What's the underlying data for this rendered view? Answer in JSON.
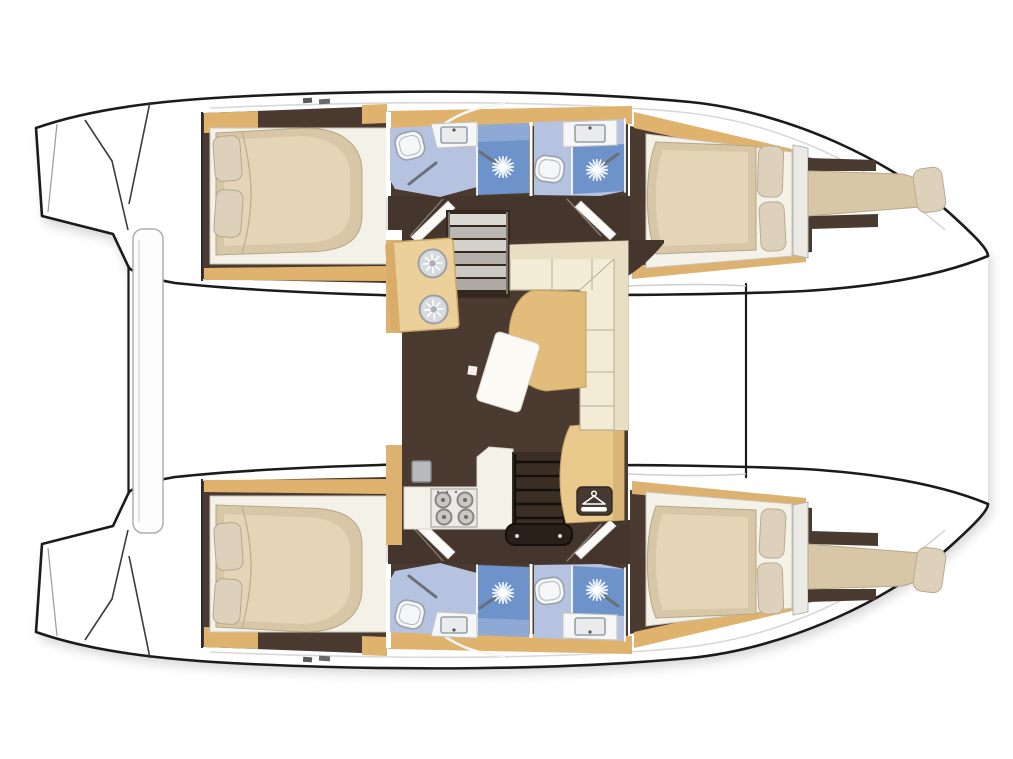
{
  "meta": {
    "type": "boat-floor-plan",
    "subject": "catamaran sailing yacht accommodation layout, top-down view",
    "orientation": "bow-right, sterns-left",
    "layout_name": "4-cabin / 4-bathroom catamaran with central saloon"
  },
  "palette": {
    "outline": "#1b1b1b",
    "shadow": "#c4c4c4",
    "deck": "#ffffff",
    "floor": "#4a3a30",
    "corridor": "#45362d",
    "wood": "#dfb26e",
    "cabinet": "#ecd09a",
    "wardrobe": "#e9c98c",
    "dark_wood": "#3a2e25",
    "settee": "#f2ebd6",
    "settee_back": "#e8dec4",
    "table": "#e2bc7a",
    "mattress": "#d8c7a7",
    "mattress_hi": "#e5d7b8",
    "bed_base": "#f4f1e9",
    "pillow": "#ddd1bb",
    "bath_floor": "#b5c3e0",
    "shower": "#6e93cb",
    "fixture_white": "#f4f6f8",
    "steel": "#b7babd",
    "icon_bg": "#463931"
  },
  "rooms": {
    "port_hull": [
      "aft double cabin",
      "aft bathroom (toilet, sink, shower)",
      "forward bathroom (toilet, sink, shower)",
      "forward double cabin",
      "forepeak crew berth"
    ],
    "starboard_hull": [
      "aft double cabin",
      "aft bathroom (toilet, sink, shower)",
      "forward bathroom (toilet, sink, shower)",
      "forward double cabin",
      "forepeak crew berth"
    ],
    "saloon": [
      "galley twin-sink unit",
      "galley counter with 4-burner stove",
      "oven appliance",
      "port companionway steps",
      "starboard companionway steps",
      "wardrobe locker",
      "L-shaped settee",
      "dining table",
      "movable coffee table"
    ],
    "exterior": [
      "transom swim steps port",
      "transom swim steps starboard",
      "aft cockpit bench",
      "forward crossbeam"
    ]
  },
  "icons": {
    "shower-spray-icon": "white starburst",
    "hanger-icon": "white clothes hanger on dark plate",
    "stove-burner-icon": "gray circle",
    "sink-basin-icon": "round basin with petal drain",
    "toilet-icon": "rounded bowl outline"
  },
  "counts": {
    "cabins": 4,
    "forepeak_berths": 2,
    "bathrooms": 4,
    "shower_sprays": 4
  }
}
